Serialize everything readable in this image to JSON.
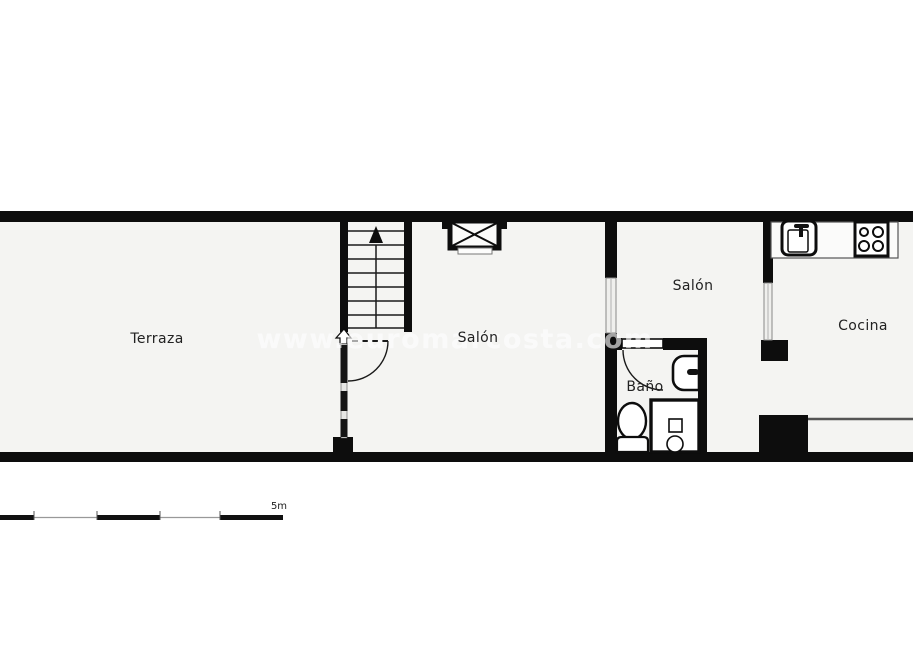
{
  "document": {
    "type": "floor-plan",
    "watermark": {
      "text": "www.euromarcosta.com"
    },
    "scale_bar": {
      "label": "5m"
    }
  },
  "rooms": [
    {
      "id": "terraza",
      "label": "Terraza"
    },
    {
      "id": "salon-main",
      "label": "Salón"
    },
    {
      "id": "salon-second",
      "label": "Salón"
    },
    {
      "id": "bano",
      "label": "Baño"
    },
    {
      "id": "cocina",
      "label": "Cocina"
    }
  ],
  "fixtures": [
    "staircase",
    "stair-up-arrow",
    "shaft-crossed-box",
    "terraza-door-swing",
    "glazed-partition",
    "bathroom-door-swing",
    "bathroom-sink",
    "toilet",
    "shower-tray",
    "kitchen-sink",
    "kitchen-hob",
    "interior-window",
    "counter"
  ],
  "colors": {
    "wall": "#0d0d0d",
    "floor": "#f4f4f2",
    "background": "#ffffff",
    "line": "#1a1a1a",
    "thin_line": "#777777",
    "window_fill": "#efefed"
  }
}
